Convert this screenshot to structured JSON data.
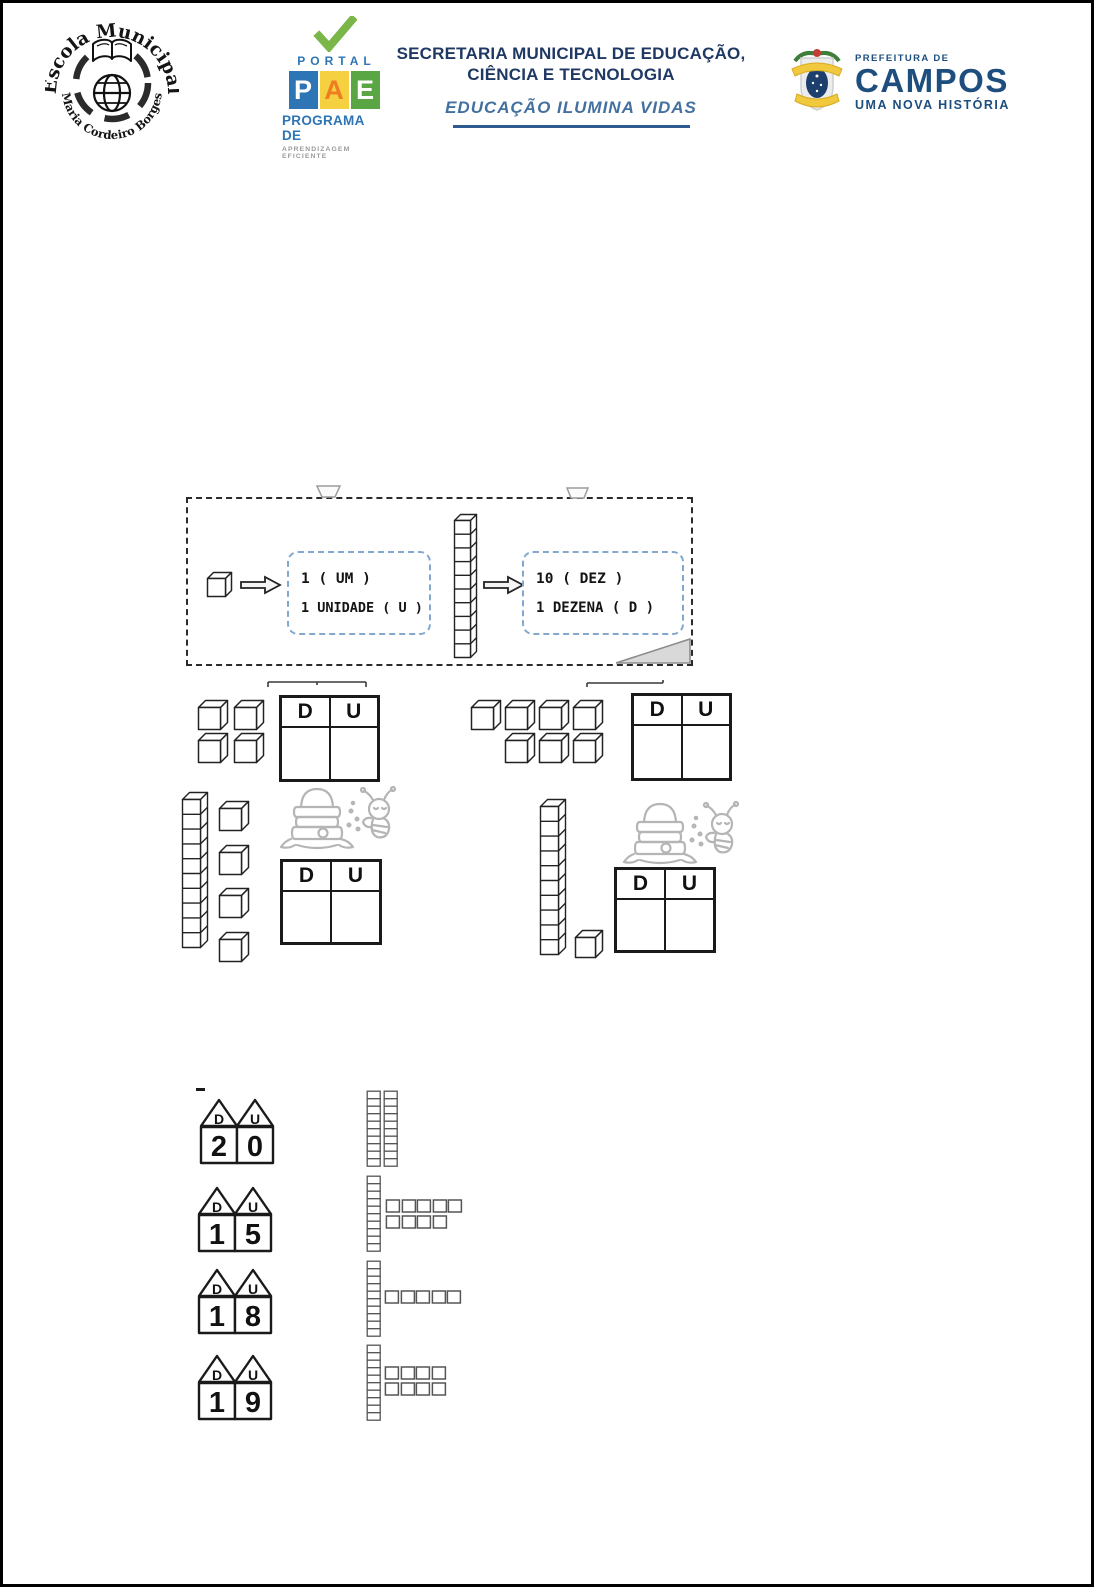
{
  "header": {
    "school": {
      "arc_top": "Escola Municipal",
      "arc_bottom": "Maria Cordeiro Borges"
    },
    "pae": {
      "portal": "PORTAL",
      "letters": [
        "P",
        "A",
        "E"
      ],
      "program": "PROGRAMA DE",
      "subtitle": "APRENDIZAGEM EFICIENTE",
      "colors": {
        "check": "#7ab648",
        "portal_blue": "#2e75b6",
        "p_bg": "#2e75b6",
        "a_bg": "#f5d040",
        "a_fg": "#ef7d22",
        "e_bg": "#5aa644",
        "subtitle_gray": "#9a9a9a"
      }
    },
    "secretariat": {
      "line1": "SECRETARIA MUNICIPAL DE EDUCAÇÃO,",
      "line2": "CIÊNCIA E TECNOLOGIA",
      "tagline": "EDUCAÇÃO ILUMINA VIDAS",
      "colors": {
        "title_navy": "#1f3864",
        "tagline_blue": "#44709f",
        "rule_blue": "#2e5b8f"
      }
    },
    "campos": {
      "pre": "PREFEITURA DE",
      "name": "CAMPOS",
      "tagline": "UMA NOVA HISTÓRIA",
      "colors": {
        "navy": "#1d4e7e",
        "ribbon_yellow": "#f0c93f",
        "oval_blue": "#1c3f6e",
        "leaf_green": "#3f7d3a",
        "cap_red": "#c43c35"
      }
    }
  },
  "place_value": {
    "tens_label": "D",
    "units_label": "U"
  },
  "legend": {
    "unit_box": {
      "line1": "1 ( UM )",
      "line2": "1 UNIDADE ( U )",
      "cubes": [
        1
      ]
    },
    "ten_box": {
      "line1": "10 ( DEZ )",
      "line2": "1 DEZENA ( D )",
      "rods": 1
    }
  },
  "exercises": {
    "count_tables": [
      {
        "units_rows": [
          2,
          2
        ],
        "represents": 4
      },
      {
        "units_rows": [
          4,
          3
        ],
        "represents": 7
      },
      {
        "rods": 1,
        "units_column": 4,
        "represents": 14
      },
      {
        "rods": 1,
        "units_column": 1,
        "represents": 11
      }
    ],
    "matching_rows": [
      {
        "tens_digit": "2",
        "units_digit": "0",
        "number": "20",
        "blocks": {
          "rods": 2,
          "unit_rows": [],
          "represents": 20
        }
      },
      {
        "tens_digit": "1",
        "units_digit": "5",
        "number": "15",
        "blocks": {
          "rods": 1,
          "unit_rows": [
            5,
            4
          ],
          "represents": 19
        }
      },
      {
        "tens_digit": "1",
        "units_digit": "8",
        "number": "18",
        "blocks": {
          "rods": 1,
          "unit_rows": [
            5
          ],
          "represents": 15
        }
      },
      {
        "tens_digit": "1",
        "units_digit": "9",
        "number": "19",
        "blocks": {
          "rods": 1,
          "unit_rows": [
            4,
            4
          ],
          "represents": 18
        }
      }
    ]
  }
}
